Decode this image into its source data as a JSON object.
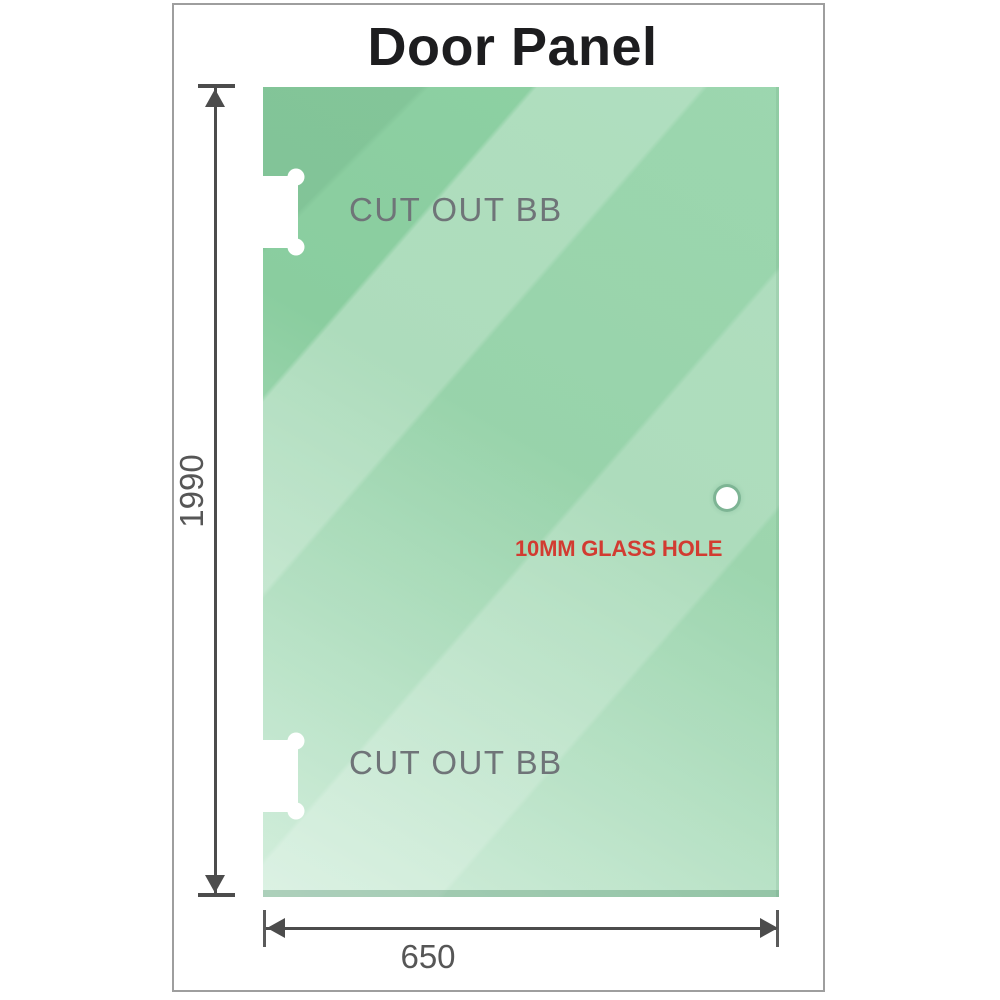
{
  "title": "Door Panel",
  "panel": {
    "cutout_top": {
      "label": "CUT OUT BB"
    },
    "cutout_bottom": {
      "label": "CUT OUT BB"
    },
    "glass_hole": {
      "label": "10MM GLASS HOLE"
    }
  },
  "dimensions": {
    "height": "1990",
    "width": "650"
  },
  "colors": {
    "glass-green": "#8ed1a4",
    "glass-green-light": "#cdecd8",
    "glass-green-dark": "#7cc496",
    "annotation-red": "#d23b31",
    "dimension-gray": "#4c4c4c",
    "label-gray": "#6f7478",
    "title-black": "#1d1d1f",
    "frame-border-gray": "#9e9e9e"
  }
}
